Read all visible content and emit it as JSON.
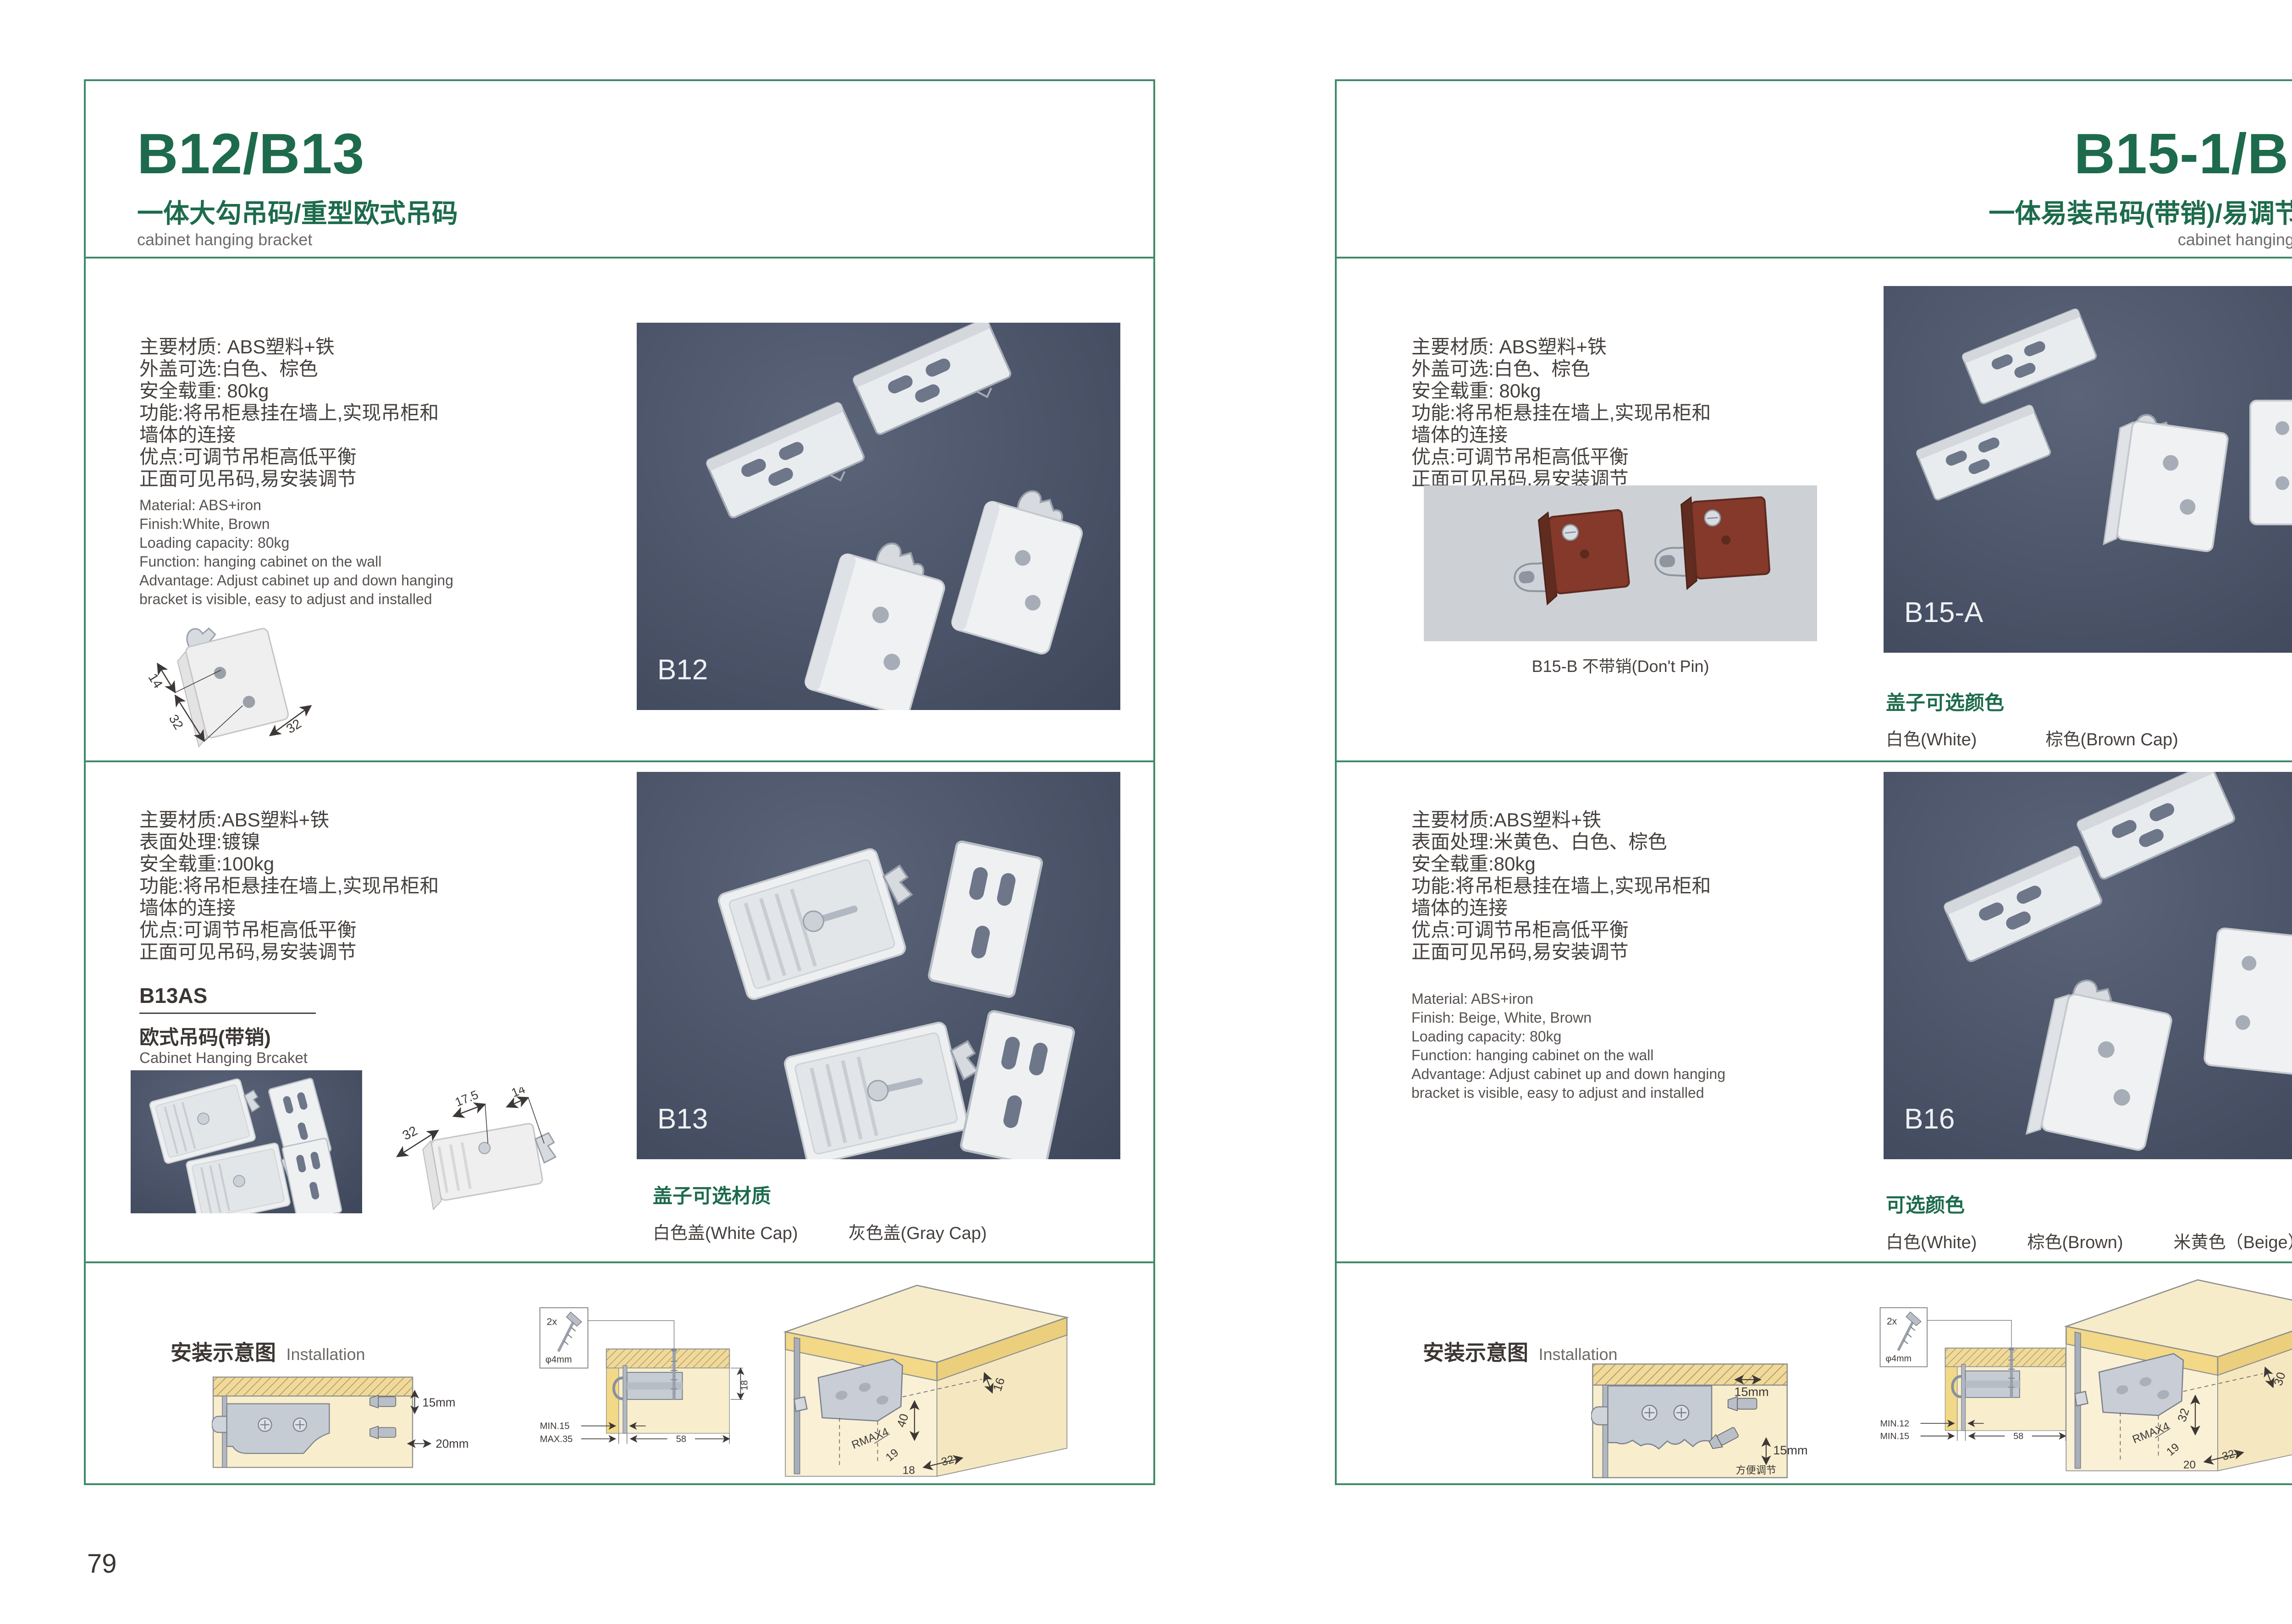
{
  "accent_green": "#1d6b4c",
  "frame_green": "#3f8a68",
  "photo_bg": "#4b5468",
  "photo_light_bg": "#cdd1d5",
  "left_page": {
    "page_number": "79",
    "header": {
      "title": "B12/B13",
      "subtitle": "一体大勾吊码/重型欧式吊码",
      "caption": "cabinet hanging bracket"
    },
    "section_b12": {
      "specs_cn": [
        "主要材质: ABS塑料+铁",
        "外盖可选:白色、棕色",
        "安全载重: 80kg",
        "功能:将吊柜悬挂在墙上,实现吊柜和",
        "墙体的连接",
        "优点:可调节吊柜高低平衡",
        "正面可见吊码,易安装调节"
      ],
      "specs_en": [
        "Material: ABS+iron",
        "Finish:White, Brown",
        "Loading capacity: 80kg",
        "Function: hanging cabinet on the wall",
        "Advantage: Adjust cabinet up and down hanging",
        "bracket is visible, easy to adjust and installed"
      ],
      "dim_photo": {
        "d1": "14",
        "d2": "32",
        "d3": "32"
      },
      "photo_label": "B12"
    },
    "section_b13": {
      "specs_cn": [
        "主要材质:ABS塑料+铁",
        "表面处理:镀镍",
        "安全载重:100kg",
        "功能:将吊柜悬挂在墙上,实现吊柜和",
        "墙体的连接",
        "优点:可调节吊柜高低平衡",
        "正面可见吊码,易安装调节"
      ],
      "model": "B13AS",
      "model_cn": "欧式吊码(带销)",
      "model_en": "Cabinet Hanging Brcaket",
      "dim_photo": {
        "d1": "32",
        "d2": "17.5",
        "d3": "14"
      },
      "photo_label": "B13",
      "caps_title": "盖子可选材质",
      "caps_options": [
        "白色盖(White Cap)",
        "灰色盖(Gray Cap)"
      ]
    },
    "installation": {
      "title_cn": "安装示意图",
      "title_en": "Installation",
      "diagram_side": {
        "dim_v": "15mm",
        "dim_h": "20mm"
      },
      "diagram_section": {
        "screw_count": "2x",
        "screw_dia": "φ4mm",
        "dim_depth": "18",
        "dim_min": "MIN.15",
        "dim_max": "MAX.35",
        "dim_width": "58"
      },
      "diagram_perspective": {
        "dim_top": "16",
        "dim_height": "40",
        "dim_r": "RMAX4",
        "dim_a": "19",
        "dim_b": "18",
        "dim_c": "32"
      }
    }
  },
  "right_page": {
    "page_number": "80",
    "header": {
      "title": "B15-1/B16",
      "subtitle": "一体易装吊码(带销)/易调节吊码",
      "caption": "cabinet hanging bracket"
    },
    "section_b15": {
      "specs_cn": [
        "主要材质: ABS塑料+铁",
        "外盖可选:白色、棕色",
        "安全载重: 80kg",
        "功能:将吊柜悬挂在墙上,实现吊柜和",
        "墙体的连接",
        "优点:可调节吊柜高低平衡",
        "正面可见吊码,易安装调节"
      ],
      "sub_photo_caption": "B15-B 不带销(Don't Pin)",
      "photo_label": "B15-A",
      "caps_title": "盖子可选颜色",
      "caps_options": [
        "白色(White)",
        "棕色(Brown Cap)"
      ]
    },
    "section_b16": {
      "specs_cn": [
        "主要材质:ABS塑料+铁",
        "表面处理:米黄色、白色、棕色",
        "安全载重:80kg",
        "功能:将吊柜悬挂在墙上,实现吊柜和",
        "墙体的连接",
        "优点:可调节吊柜高低平衡",
        "正面可见吊码,易安装调节"
      ],
      "specs_en": [
        "Material: ABS+iron",
        "Finish: Beige, White, Brown",
        "Loading capacity: 80kg",
        "Function: hanging cabinet on the wall",
        "Advantage: Adjust cabinet up and down hanging",
        "bracket is visible, easy to adjust and installed"
      ],
      "photo_label": "B16",
      "colors_title": "可选颜色",
      "colors_options": [
        "白色(White)",
        "棕色(Brown)",
        "米黄色（Beige）"
      ]
    },
    "installation": {
      "title_cn": "安装示意图",
      "title_en": "Installation",
      "diagram_side": {
        "dim_h": "15mm",
        "dim_v": "15mm",
        "note": "方便调节"
      },
      "diagram_section": {
        "screw_count": "2x",
        "screw_dia": "φ4mm",
        "dim_a": "19",
        "dim_b": "32",
        "dim_min": "MIN.12",
        "dim_max": "MIN.15",
        "dim_width": "58"
      },
      "diagram_perspective": {
        "dim_top": "30",
        "dim_height": "32",
        "dim_r": "RMAX4",
        "dim_a": "19",
        "dim_b": "20",
        "dim_c": "32"
      }
    }
  }
}
